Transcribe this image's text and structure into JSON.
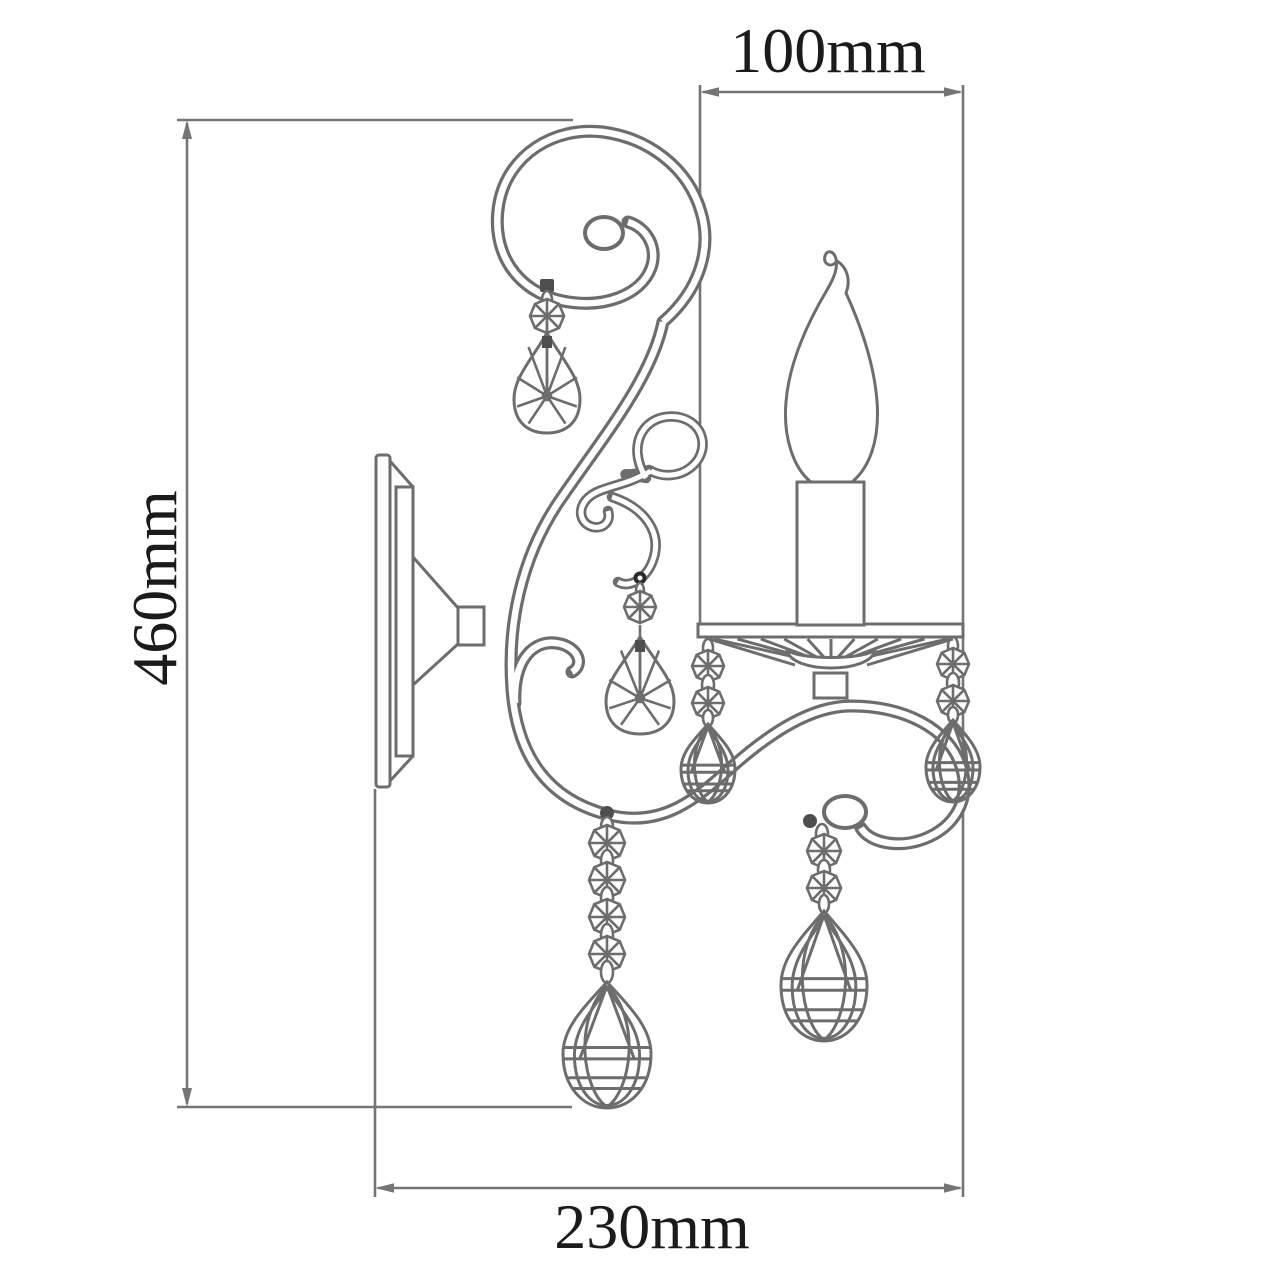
{
  "drawing": {
    "type": "technical-dimension-drawing",
    "subject": "single-arm wall sconce with candle and crystal pendants, side view",
    "units": "mm",
    "colors": {
      "background": "#ffffff",
      "line": "#6d6d6d",
      "dimension_line": "#757575",
      "text": "#1b1b1b"
    }
  },
  "dimensions": {
    "top_width": "100mm",
    "top_width_value": 100,
    "height": "460mm",
    "height_value": 460,
    "bottom_depth": "230mm",
    "bottom_depth_value": 230
  }
}
